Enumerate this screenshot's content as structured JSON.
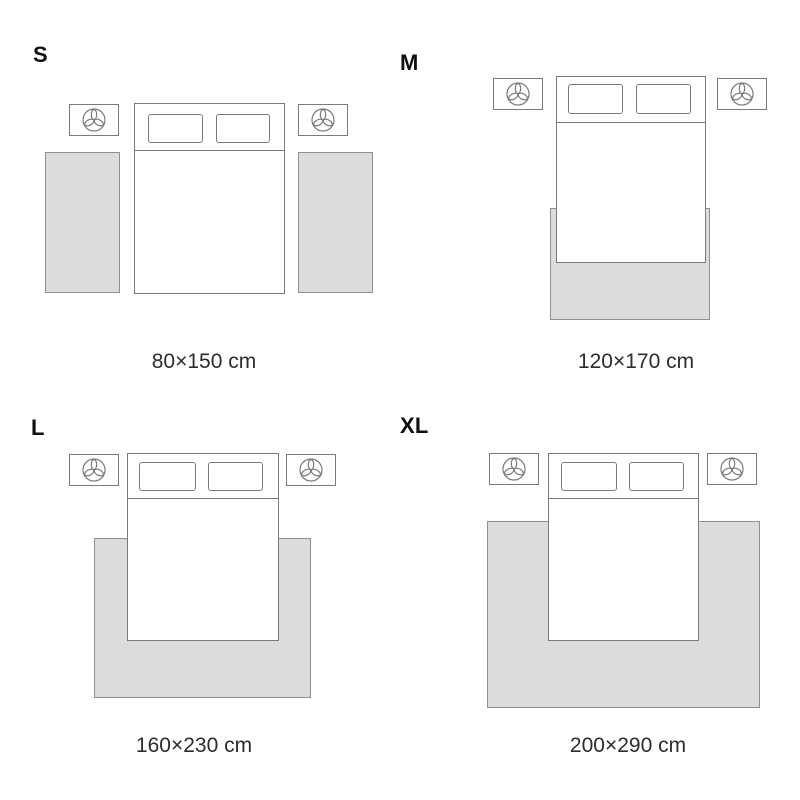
{
  "colors": {
    "background": "#ffffff",
    "rug_fill": "#dcdcdc",
    "rug_border": "#8f8f8f",
    "furniture_line": "#7a7a7a",
    "label_text": "#0f0f0f",
    "caption_text": "#2d2d2d"
  },
  "icons": {
    "nightstand": "plant-top-view-icon"
  },
  "panels": [
    {
      "id": "s",
      "label": "S",
      "caption": "80×150 cm",
      "rug_placement": "two side runners beside bed"
    },
    {
      "id": "m",
      "label": "M",
      "caption": "120×170 cm",
      "rug_placement": "under foot of bed"
    },
    {
      "id": "l",
      "label": "L",
      "caption": "160×230 cm",
      "rug_placement": "under lower half of bed, side overhang"
    },
    {
      "id": "xl",
      "label": "XL",
      "caption": "200×290 cm",
      "rug_placement": "large rug under most of bed"
    }
  ]
}
